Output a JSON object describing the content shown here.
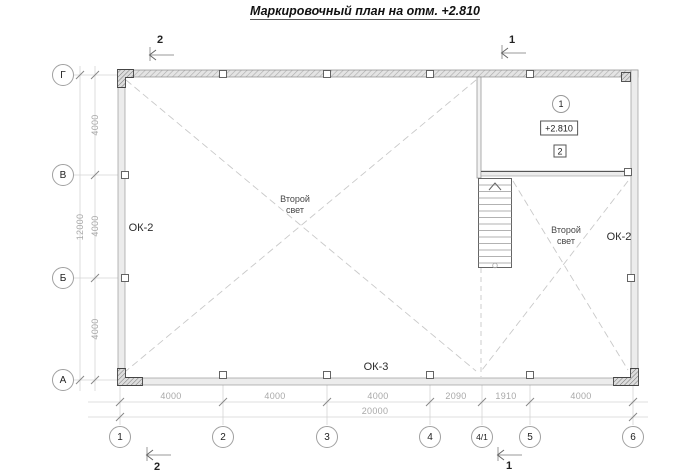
{
  "title": "Маркировочный план на отм. +2.810",
  "axis_rows": [
    {
      "label": "Г"
    },
    {
      "label": "В"
    },
    {
      "label": "Б"
    },
    {
      "label": "А"
    }
  ],
  "axis_cols": [
    {
      "label": "1"
    },
    {
      "label": "2"
    },
    {
      "label": "3"
    },
    {
      "label": "4"
    },
    {
      "label": "4/1"
    },
    {
      "label": "5"
    },
    {
      "label": "6"
    }
  ],
  "dimensions": {
    "left_segments": [
      "4000",
      "4000",
      "4000"
    ],
    "left_total": "12000",
    "bottom_segments": [
      "4000",
      "4000",
      "4000",
      "2090",
      "1910",
      "4000"
    ],
    "bottom_total": "20000"
  },
  "sections": {
    "top_left": "2",
    "top_right": "1",
    "bottom_left": "2",
    "bottom_right": "1"
  },
  "room_labels": {
    "ok2_left": "ОК-2",
    "ok2_right": "ОК-2",
    "ok3": "ОК-3",
    "second_light_main": "Второй\nсвет",
    "second_light_right": "Второй\nсвет"
  },
  "mezzanine": {
    "node_number": "1",
    "elevation": "+2.810",
    "mark_number": "2"
  },
  "icons": {
    "stairs_direction": "up-arrow-icon"
  },
  "colors": {
    "line_dark": "#444444",
    "wall_fill": "#ececec",
    "dimension_gray": "#a8a8a8",
    "dashed_void": "#c9c9c9"
  }
}
